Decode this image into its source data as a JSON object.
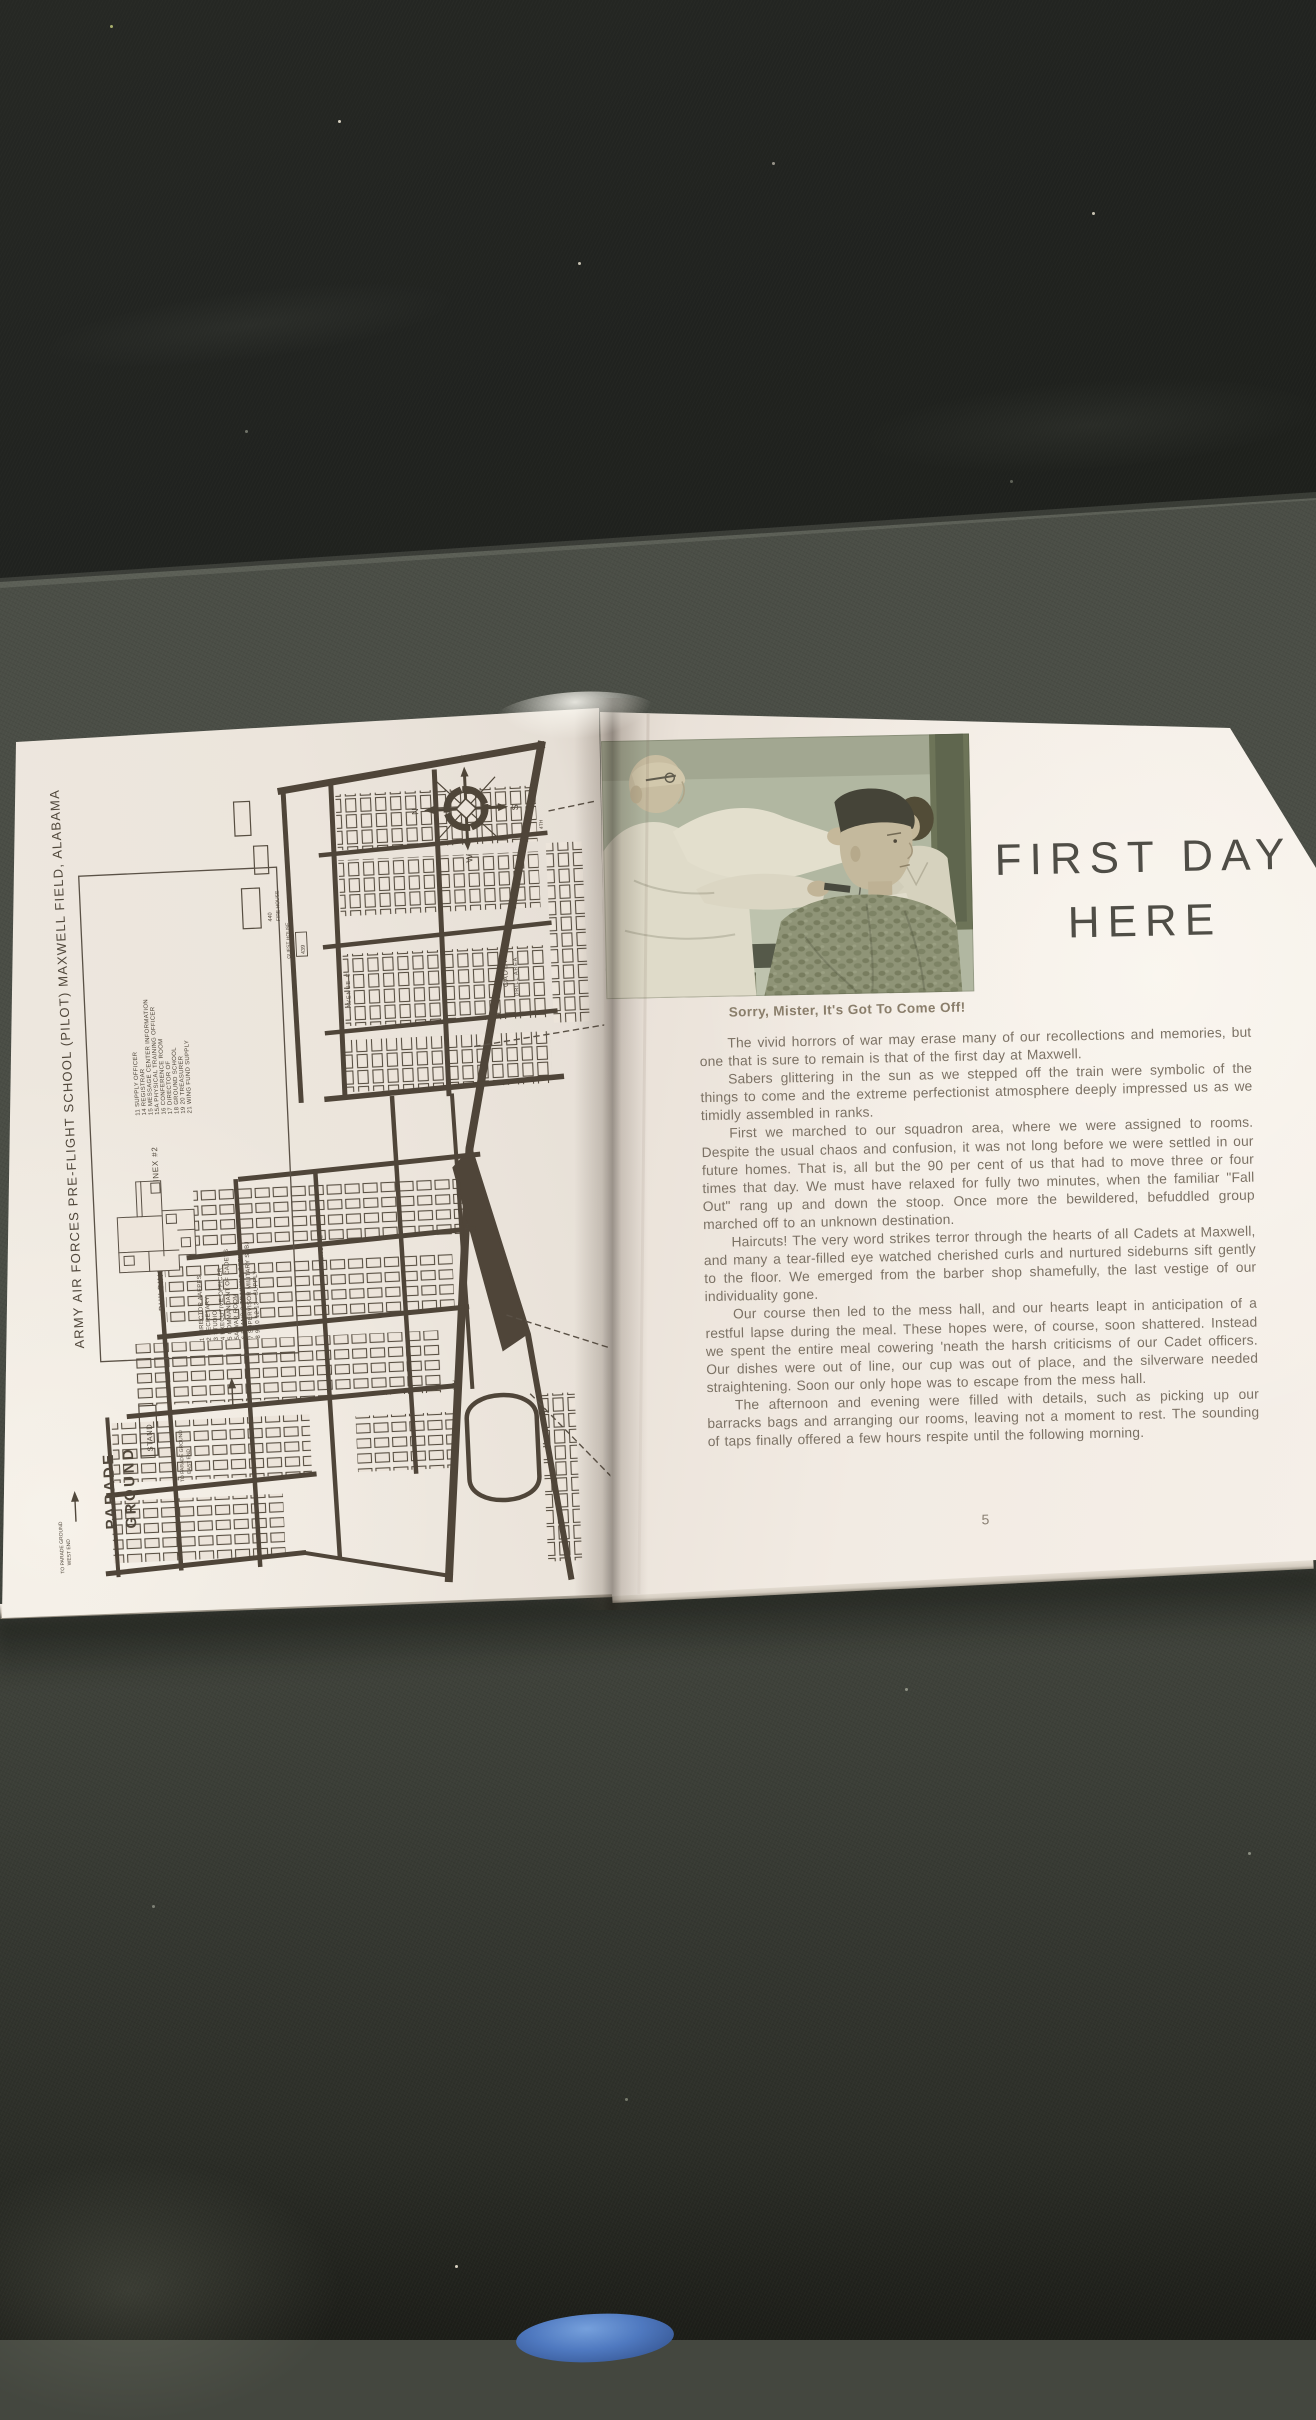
{
  "colors": {
    "fabric_dark": "#222421",
    "fabric_mid": "#4a4d46",
    "page_cream": "#efe8e0",
    "map_ink": "#51483c",
    "body_text": "#7b7164",
    "title_ink": "#4f4d46",
    "photo_wall": "#b4baa5",
    "blue_object": "#4f79c0"
  },
  "book": {
    "left_page": {
      "map": {
        "title_vertical": "ARMY  AIR  FORCES  PRE-FLIGHT  SCHOOL  (PILOT)  MAXWELL  FIELD,  ALABAMA",
        "legend": {
          "title": "BUILDING #37 - POST HQ. ANNEX #2",
          "column1": [
            "1 DIRECTOR AAFPFS",
            "2 SECRETARY",
            "3 STUDIO",
            "4 EXECUTIVE OFFICER",
            "5 COMMANDANT OF CADETS",
            "5A WAR ROOM",
            "6 PLANS & TRAINING OFFICER",
            "7 SUPERVISOR MILITARY SUBJ",
            "8 9 10 12 13 - SUPPLY"
          ],
          "column2": [
            "11 SUPPLY OFFICER",
            "14 REGISTRAR",
            "15 MESSAGE CENTER INFORMATION",
            "15A PHYSICAL TRAINING OFFICER",
            "16 CONFERENCE ROOM",
            "17 DIRECTOR OF",
            "18 GROUND SCHOOL",
            "19 20 TREASURER",
            "21 WING FUND SUPPLY"
          ]
        },
        "labels": {
          "parade_line1": "PARADE",
          "parade_line2": "GROUND",
          "stand": "STAND",
          "to_parade_east_1": "TO PARADE GROUND",
          "to_parade_east_2": "EAST END",
          "to_parade_west_1": "TO PARADE GROUND",
          "to_parade_west_2": "WEST END",
          "cadet_line1": "CADET",
          "cadet_line2": "DRILL AREA",
          "fire_house": "FIRE HOUSE",
          "fire_house_number": "440",
          "guest_house": "GUEST HOUSE",
          "guest_house_number": "439",
          "avenue_c": "AVENUE  C",
          "avenue_e": "AVENUE  E",
          "street_tags": [
            "4TH",
            "5TH",
            "6TH",
            "7TH",
            "8TH"
          ]
        },
        "compass": {
          "n": "N",
          "e": "E",
          "s": "S",
          "w": "W"
        }
      }
    },
    "right_page": {
      "title_line1": "FIRST DAY",
      "title_line2": "HERE",
      "photo_caption": "Sorry, Mister, It's Got To Come Off!",
      "paragraphs": [
        "The vivid horrors of war may erase many of our recollections and memories, but one that is sure to remain is that of the first day at Maxwell.",
        "Sabers glittering in the sun as we stepped off the train were symbolic of the things to come and the extreme perfectionist atmosphere deeply impressed us as we timidly assembled in ranks.",
        "First we marched to our squadron area, where we were assigned to rooms. Despite the usual chaos and confusion, it was not long before we were settled in our future homes.  That is, all but the 90 per cent of us that had to move three or four times that day.  We must have relaxed for fully two minutes, when the familiar \"Fall Out\" rang up and down the stoop.  Once more the bewildered, befuddled group marched off to an unknown destination.",
        "Haircuts!  The very word strikes terror through the hearts of all Cadets at Maxwell, and many a tear-filled eye watched cherished curls and nurtured sideburns sift gently to the floor.  We emerged from the barber shop shamefully, the last vestige of our individuality gone.",
        "Our course then led to the mess hall, and our hearts leapt in anticipation of a restful lapse during the meal.  These hopes were, of course, soon shattered. Instead we spent the entire meal cowering 'neath the harsh criticisms of our Cadet officers.  Our dishes were out of line, our cup was out of place, and the silverware needed straightening.  Soon our only hope was to escape from the mess hall.",
        "The afternoon and evening were filled with details, such as picking up our barracks bags and arranging our rooms, leaving not a moment to rest.  The sounding of taps finally offered a few hours respite until the following morning."
      ],
      "page_number": "5"
    }
  }
}
